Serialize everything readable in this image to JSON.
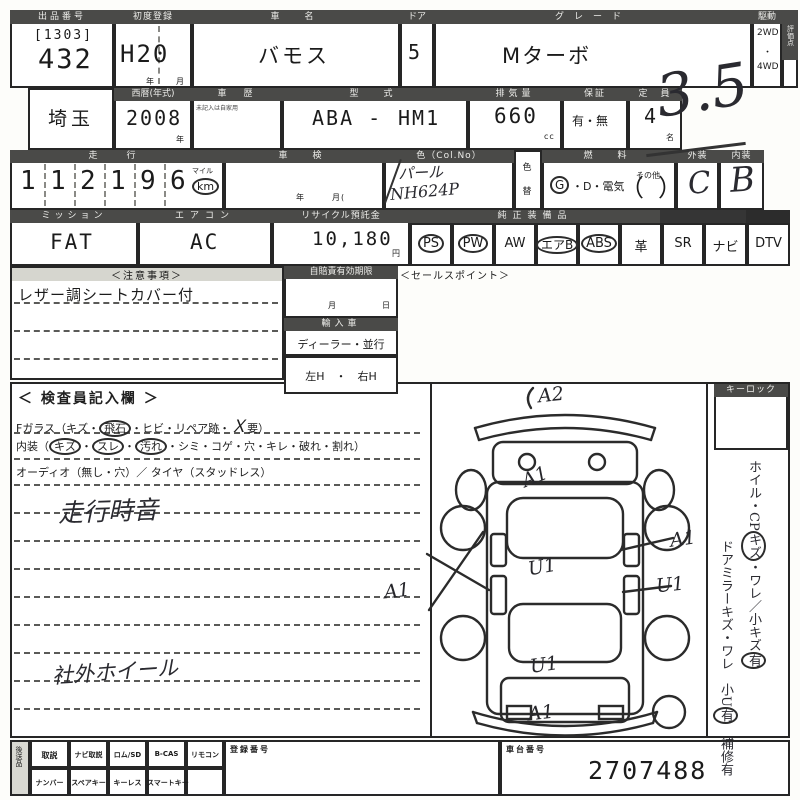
{
  "row1": {
    "lot_label": "出品番号",
    "lot_bracket": "[1303]",
    "lot_number": "432",
    "first_reg_label": "初度登録",
    "first_reg_value": "H20",
    "first_reg_year": "年",
    "first_reg_month": "月",
    "name_label": "車　名",
    "name_value": "バモス",
    "door_label": "ドア",
    "door_value": "5",
    "grade_label": "グレード",
    "grade_value": "Mターボ",
    "drive_label": "駆動",
    "drive_top": "2WD",
    "drive_dot": "・",
    "drive_bottom": "4WD",
    "score_label": "評価点",
    "score_value": "3.5"
  },
  "row2": {
    "prefecture": "埼玉",
    "year_label": "西暦(年式)",
    "year_value": "2008",
    "year_unit": "年",
    "history_label": "車　歴",
    "history_note": "未記入は自家用",
    "model_label": "型　式",
    "model_left": "ABA -",
    "model_right": "HM1",
    "displacement_label": "排気量",
    "displacement_value": "660",
    "displacement_unit": "cc",
    "warranty_label": "保証",
    "warranty_value": "有・無",
    "capacity_label": "定　員",
    "capacity_value": "4",
    "capacity_unit": "名"
  },
  "row3": {
    "mileage_label": "走　行",
    "digits": [
      "1",
      "1",
      "2",
      "1",
      "9",
      "6"
    ],
    "mile_label": "マイル",
    "km_label": "km",
    "shaken_label": "車　検",
    "shaken_year": "年",
    "shaken_month": "月(",
    "color_label": "色（Col.No）",
    "color_value": "パール",
    "color_code": "NH624P",
    "color_change_top": "色",
    "color_change_bottom": "替",
    "fuel_label": "燃　料",
    "fuel_g": "G",
    "fuel_mid": "・D・電気",
    "fuel_open": "（",
    "fuel_other": "その他",
    "fuel_close": "）",
    "exterior_label": "外装",
    "exterior_value": "C",
    "interior_label": "内装",
    "interior_value": "B"
  },
  "row4": {
    "shift_label": "ミッション",
    "shift_value": "FAT",
    "aircon_label": "エアコン",
    "aircon_value": "AC",
    "recycle_label": "リサイクル預託金",
    "recycle_value": "10,180",
    "recycle_unit": "円",
    "equipment_label": "純正装備品",
    "equipment": [
      {
        "label": "PS",
        "circled": true
      },
      {
        "label": "PW",
        "circled": true
      },
      {
        "label": "AW",
        "circled": false
      },
      {
        "label": "エアB",
        "circled": true
      },
      {
        "label": "ABS",
        "circled": true
      },
      {
        "label": "革",
        "circled": false
      },
      {
        "label": "SR",
        "circled": false
      },
      {
        "label": "ナビ",
        "circled": false
      },
      {
        "label": "DTV",
        "circled": false
      }
    ]
  },
  "notes": {
    "title": "＜注意事項＞",
    "line1": "レザー調シートカバー付",
    "insurance_label": "自賠責有効期限",
    "month": "月",
    "day": "日",
    "import_label": "輸入車",
    "import_value": "ディーラー・並行",
    "handle_value": "左H　・　右H",
    "sales_label": "＜セールスポイント＞"
  },
  "inspector": {
    "title": "＜ 検査員記入欄 ＞",
    "glass_prefix": "Fガラス（キズ・",
    "glass_circled": "飛石",
    "glass_mid": "・ヒビ・リペア跡・",
    "glass_hand": "Ｘ",
    "glass_suffix": "要）",
    "interior_open": "内装（",
    "interior_c1": "キズ",
    "sep1": "・",
    "interior_c2": "スレ",
    "sep2": "・",
    "interior_c3": "汚れ",
    "interior_rest": "・シミ・コゲ・穴・キレ・破れ・割れ）",
    "audio_line": "オーディオ（無し・穴）／ タイヤ（スタッドレス）",
    "hand_note1": "走行時音",
    "hand_note2": "社外ホイール"
  },
  "diagram": {
    "annotations": [
      {
        "text": "A2"
      },
      {
        "text": "A1"
      },
      {
        "text": "A1"
      },
      {
        "text": "A1"
      },
      {
        "text": "U1"
      },
      {
        "text": "U1"
      },
      {
        "text": "U1"
      },
      {
        "text": "A1"
      }
    ]
  },
  "sidebar": {
    "keylock_label": "キーロック",
    "col1_pre": "ホイル・CP",
    "col1_c1": "キズ",
    "col1_mid": "・ワレ／小キズ",
    "col1_c2": "有",
    "col2_pre": "ドアミラーキズ・ワレ　小U",
    "col2_c1": "有",
    "col2_post": "　補修有"
  },
  "bottom": {
    "send_label": "後送品",
    "row1": [
      "取説",
      "ナビ取説",
      "ロム/SD",
      "B-CAS",
      "リモコン"
    ],
    "row2": [
      "ナンバー",
      "スペアキー",
      "キーレス",
      "スマートキー",
      ""
    ],
    "reg_label": "登録番号",
    "chassis_label": "車台番号",
    "chassis_value": "2707488"
  }
}
